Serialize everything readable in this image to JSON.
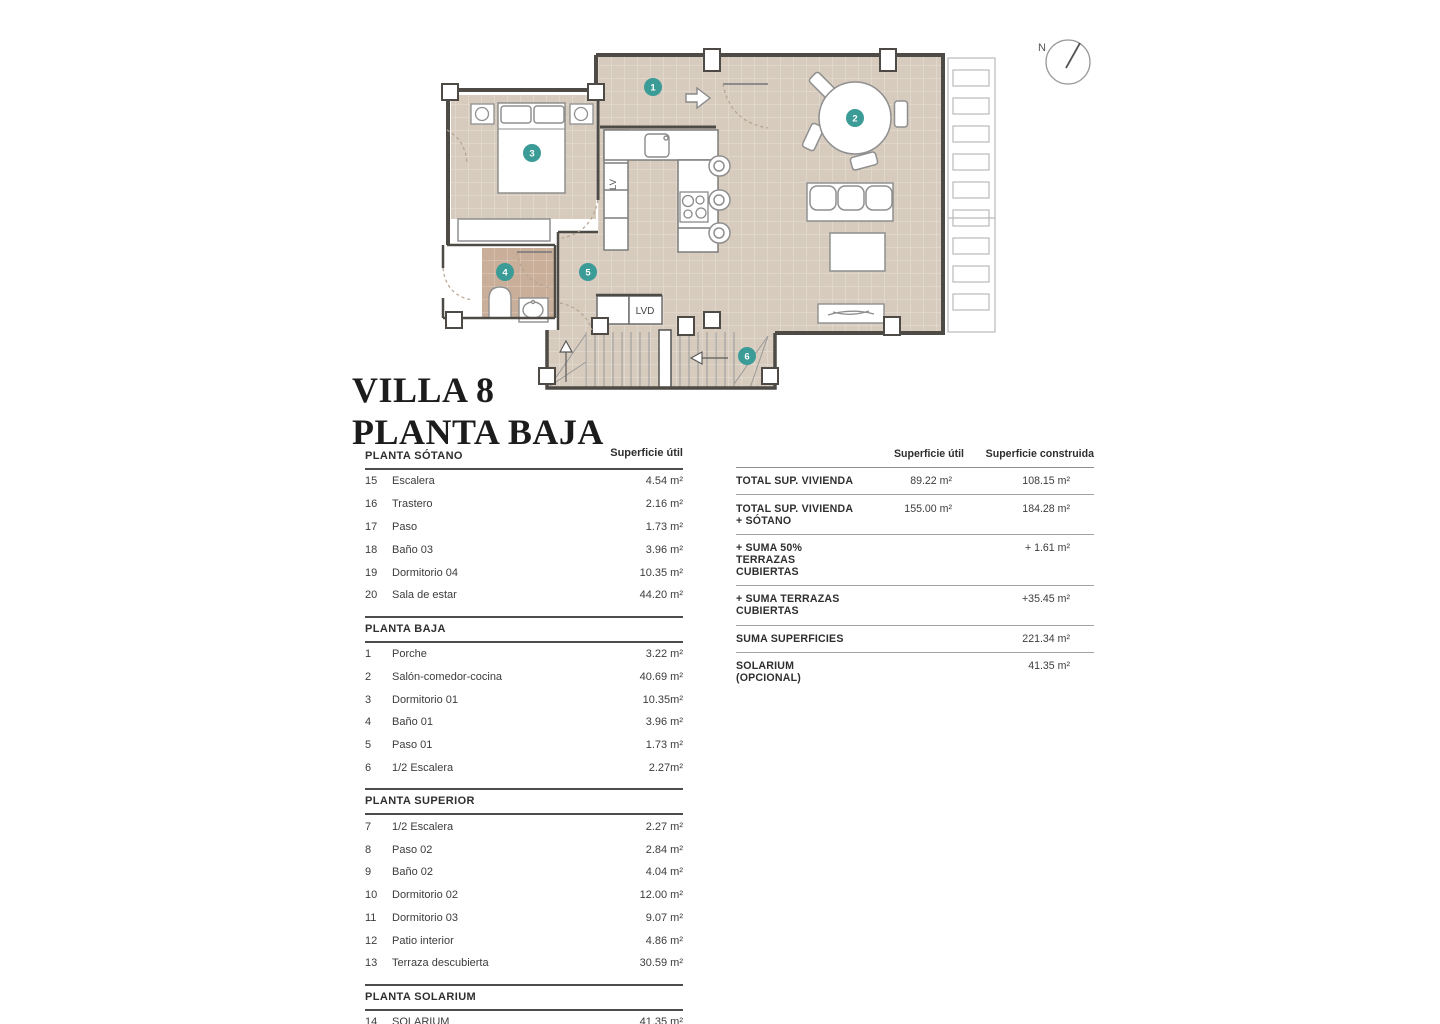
{
  "title": {
    "line1": "VILLA 8",
    "line2": "PLANTA BAJA"
  },
  "floorplan": {
    "labels": {
      "lv": "LV",
      "lvd": "LVD",
      "north": "N"
    },
    "badges": [
      "1",
      "2",
      "3",
      "4",
      "5",
      "6"
    ],
    "colors": {
      "floor": "#d6cbbd",
      "bath_floor": "#c9af9a",
      "badge": "#3b9b97",
      "wall": "#4e4a45"
    }
  },
  "left_table": {
    "superficie_header": "Superficie útil",
    "sections": [
      {
        "title": "PLANTA SÓTANO",
        "rows": [
          {
            "num": "15",
            "name": "Escalera",
            "value": "4.54 m²"
          },
          {
            "num": "16",
            "name": "Trastero",
            "value": "2.16 m²"
          },
          {
            "num": "17",
            "name": "Paso",
            "value": "1.73 m²"
          },
          {
            "num": "18",
            "name": "Baño 03",
            "value": "3.96 m²"
          },
          {
            "num": "19",
            "name": "Dormitorio 04",
            "value": "10.35 m²"
          },
          {
            "num": "20",
            "name": "Sala de estar",
            "value": "44.20 m²"
          }
        ]
      },
      {
        "title": "PLANTA BAJA",
        "rows": [
          {
            "num": "1",
            "name": "Porche",
            "value": "3.22 m²"
          },
          {
            "num": "2",
            "name": "Salón-comedor-cocina",
            "value": "40.69 m²"
          },
          {
            "num": "3",
            "name": "Dormitorio 01",
            "value": "10.35m²"
          },
          {
            "num": "4",
            "name": "Baño 01",
            "value": "3.96 m²"
          },
          {
            "num": "5",
            "name": "Paso 01",
            "value": "1.73 m²"
          },
          {
            "num": "6",
            "name": "1/2 Escalera",
            "value": "2.27m²"
          }
        ]
      },
      {
        "title": "PLANTA SUPERIOR",
        "rows": [
          {
            "num": "7",
            "name": "1/2 Escalera",
            "value": "2.27 m²"
          },
          {
            "num": "8",
            "name": "Paso 02",
            "value": "2.84 m²"
          },
          {
            "num": "9",
            "name": "Baño 02",
            "value": "4.04 m²"
          },
          {
            "num": "10",
            "name": "Dormitorio 02",
            "value": "12.00 m²"
          },
          {
            "num": "11",
            "name": "Dormitorio 03",
            "value": "9.07 m²"
          },
          {
            "num": "12",
            "name": "Patio interior",
            "value": "4.86 m²"
          },
          {
            "num": "13",
            "name": "Terraza descubierta",
            "value": "30.59 m²"
          }
        ]
      },
      {
        "title": "PLANTA SOLARIUM",
        "rows": [
          {
            "num": "14",
            "name": "SOLARIUM",
            "value": "41.35 m²"
          }
        ]
      }
    ]
  },
  "summary_table": {
    "col_util": "Superficie útil",
    "col_construida": "Superficie construida",
    "rows": [
      {
        "label": "TOTAL SUP. VIVIENDA",
        "util": "89.22 m²",
        "construida": "108.15 m²"
      },
      {
        "label": "TOTAL SUP. VIVIENDA + SÓTANO",
        "util": "155.00  m²",
        "construida": "184.28 m²"
      },
      {
        "label": "+ SUMA 50% TERRAZAS CUBIERTAS",
        "util": "",
        "construida": "+ 1.61 m²"
      },
      {
        "label": "+ SUMA TERRAZAS CUBIERTAS",
        "util": "",
        "construida": "+35.45 m²"
      },
      {
        "label": "SUMA SUPERFICIES",
        "util": "",
        "construida": "221.34 m²"
      },
      {
        "label": "SOLARIUM (OPCIONAL)",
        "util": "",
        "construida": "41.35 m²"
      }
    ]
  }
}
